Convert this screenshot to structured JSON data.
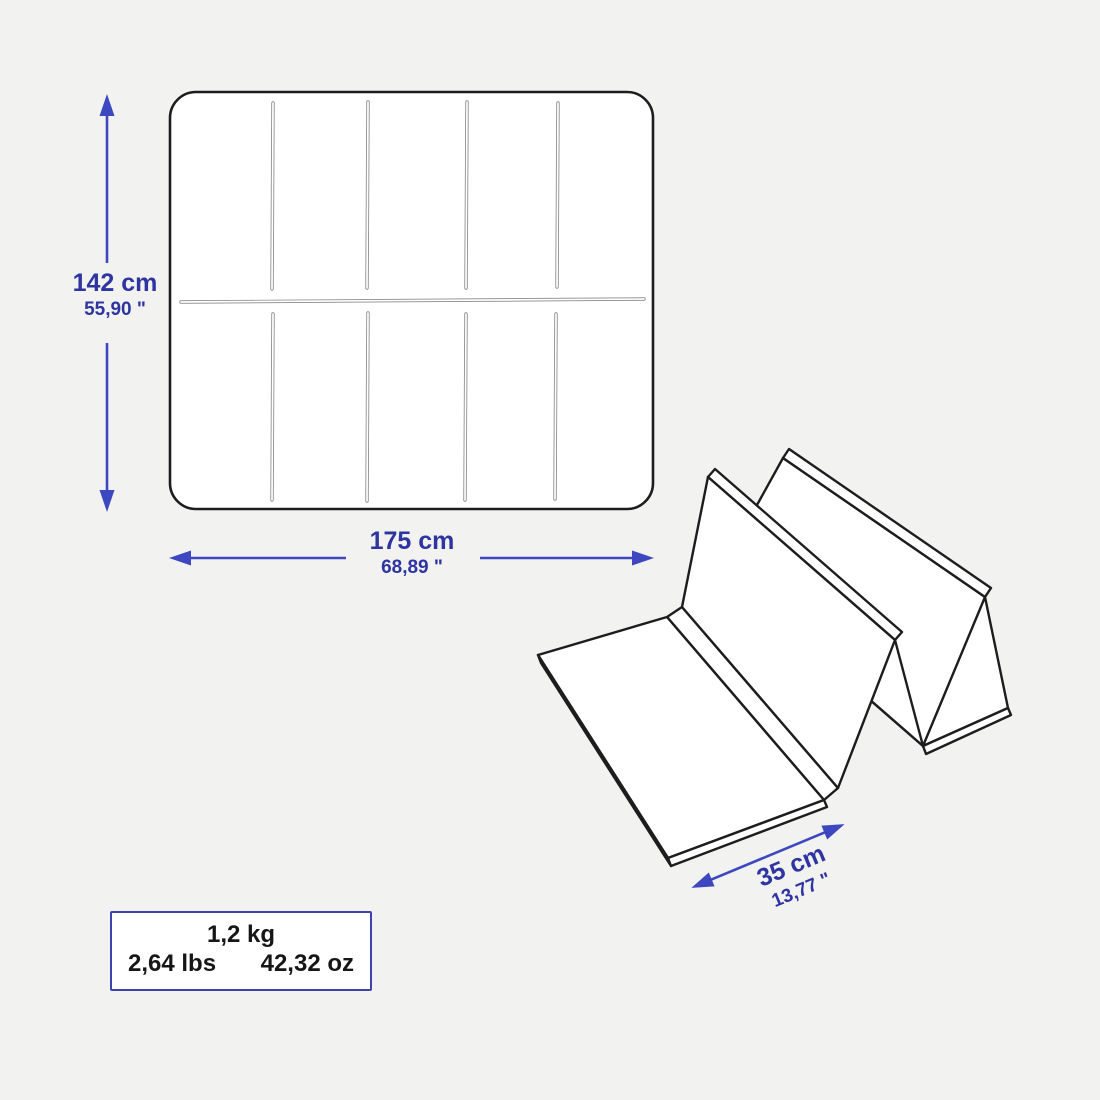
{
  "page": {
    "type": "product-dimension-diagram",
    "subject": "foldable exercise mat"
  },
  "colors": {
    "background": "#f2f2f0",
    "surface": "#ffffff",
    "outline": "#1d1d1d",
    "seam": "#8a8a8a",
    "arrow": "#3c47c0",
    "dimension_text": "#2e34a0",
    "box_border": "#3d44ad",
    "weight_text": "#161616"
  },
  "icons": {
    "unfolded_mat": "unfolded-mat-line-drawing",
    "folded_mat": "accordion-folded-mat-line-drawing",
    "height_arrow": "vertical-double-arrow",
    "width_arrow": "horizontal-double-arrow",
    "depth_arrow": "diagonal-double-arrow"
  },
  "dimensions": {
    "height": {
      "metric": "142 cm",
      "imperial": "55,90 \""
    },
    "width": {
      "metric": "175 cm",
      "imperial": "68,89 \""
    },
    "depth": {
      "metric": "35 cm",
      "imperial": "13,77 \""
    }
  },
  "weight": {
    "kg": "1,2 kg",
    "lbs": "2,64 lbs",
    "oz": "42,32 oz"
  }
}
